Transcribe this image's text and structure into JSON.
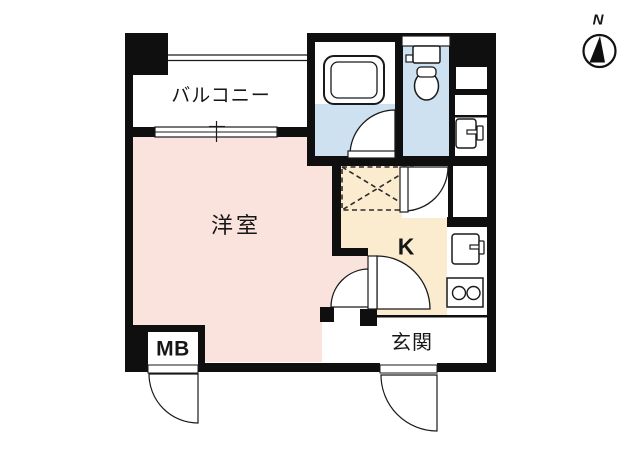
{
  "plan": {
    "type": "apartment-floor-plan",
    "rooms": {
      "balcony": {
        "label": "バルコニー"
      },
      "western_room": {
        "label": "洋室"
      },
      "kitchen": {
        "label": "K"
      },
      "entrance": {
        "label": "玄関"
      },
      "meter_box": {
        "label": "MB"
      }
    },
    "compass": {
      "label": "N"
    },
    "colors": {
      "wall": "#0f0f0f",
      "western_room_floor": "#fbe3dd",
      "kitchen_floor": "#fbecd0",
      "bathroom_floor": "#cde1f0",
      "toilet_floor": "#cde1f0",
      "hall_floor": "#ffffff",
      "line": "#1a1a1a"
    },
    "fixtures": [
      "bathtub-icon",
      "toilet-icon",
      "washbasin-icon",
      "kitchen-sink-icon",
      "stove-two-burner-icon",
      "appliance-space-dashed-icon",
      "door-swing-arc",
      "window-double-line",
      "compass-north-icon"
    ]
  }
}
